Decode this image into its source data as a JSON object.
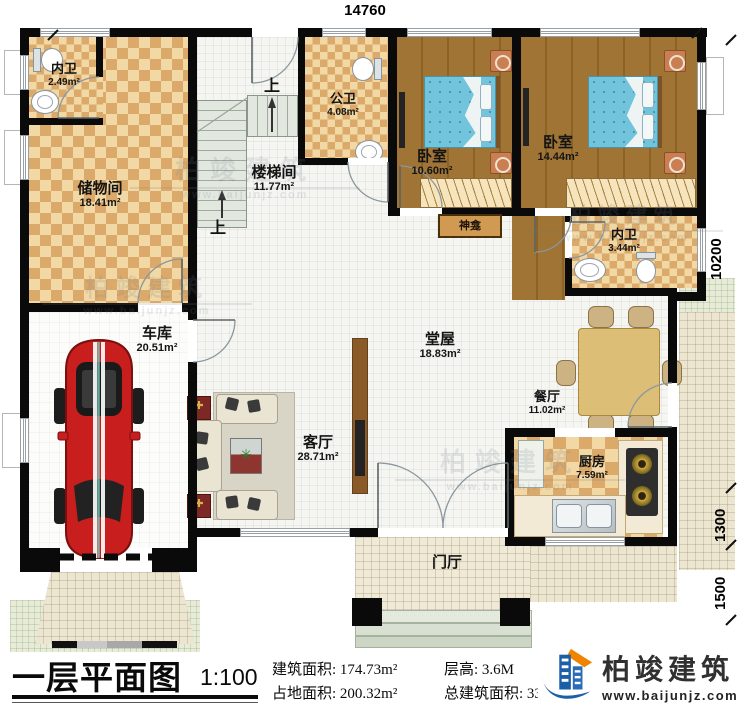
{
  "plan": {
    "title_note": "first-floor architectural plan"
  },
  "dimensions": {
    "top": "14760",
    "right_total": "10200",
    "right_mid": "1300",
    "right_bottom": "1500"
  },
  "rooms": {
    "neiwei1": {
      "name": "内卫",
      "area": "2.49m²"
    },
    "chuwujian": {
      "name": "储物间",
      "area": "18.41m²"
    },
    "loutijian": {
      "name": "楼梯间",
      "area": "11.77m²"
    },
    "gongwei": {
      "name": "公卫",
      "area": "4.08m²"
    },
    "woshi1": {
      "name": "卧室",
      "area": "10.60m²"
    },
    "woshi2": {
      "name": "卧室",
      "area": "14.44m²"
    },
    "neiwei2": {
      "name": "内卫",
      "area": "3.44m²"
    },
    "shenkan": {
      "name": "神龛"
    },
    "tangwu": {
      "name": "堂屋",
      "area": "18.83m²"
    },
    "canting": {
      "name": "餐厅",
      "area": "11.02m²"
    },
    "chufang": {
      "name": "厨房",
      "area": "7.59m²"
    },
    "keting": {
      "name": "客厅",
      "area": "28.71m²"
    },
    "cheku": {
      "name": "车库",
      "area": "20.51m²"
    },
    "menting": {
      "name": "门厅"
    }
  },
  "stairs": {
    "up": "上"
  },
  "footer": {
    "title": "一层平面图",
    "scale": "1:100",
    "stats": [
      {
        "label": "建筑面积:",
        "value": "174.73m²"
      },
      {
        "label": "层高:",
        "value": "3.6M"
      },
      {
        "label": "占地面积:",
        "value": "200.32m²"
      },
      {
        "label": "总建筑面积:",
        "value": "338.25m²"
      }
    ],
    "brand": {
      "name": "柏竣建筑",
      "url": "www.baijunjz.com",
      "brand_blue": "#1b5fa8",
      "brand_orange": "#f08300"
    }
  },
  "watermark": {
    "name": "柏竣建筑",
    "url": "www.baijunjz.com"
  }
}
